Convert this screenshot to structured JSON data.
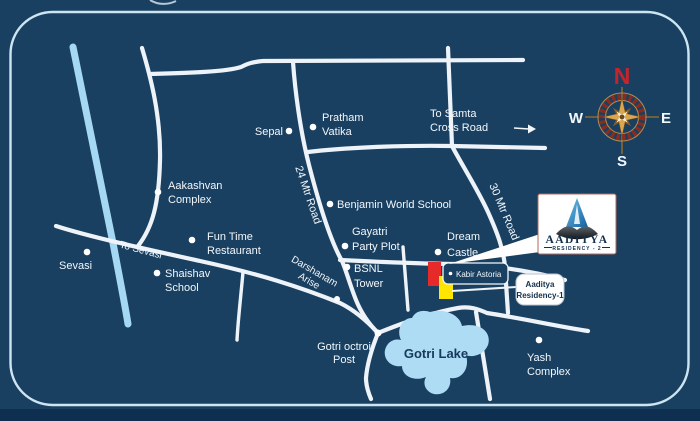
{
  "colors": {
    "background": "#1a4061",
    "page_bottom_strip": "#0f2f51",
    "road": "#edf3f8",
    "frame_border": "#cde5f2",
    "canal": "#a5d8f2",
    "lake": "#aedcf5",
    "lake_text": "#16395c",
    "marker_red": "#e62a2a",
    "marker_yellow": "#ffe600",
    "compass_north": "#c4242b",
    "brand_navy": "#132f4e"
  },
  "places": {
    "sepal": {
      "lines": [
        "Sepal"
      ]
    },
    "pratham_vatika": {
      "lines": [
        "Pratham",
        "Vatika"
      ]
    },
    "samta": {
      "lines": [
        "To Samta",
        "Cross Road"
      ]
    },
    "aakashvan_complex": {
      "lines": [
        "Aakashvan",
        "Complex"
      ]
    },
    "benjamin_world_school": {
      "lines": [
        "Benjamin World School"
      ]
    },
    "gayatri_party_plot": {
      "lines": [
        "Gayatri",
        "Party Plot"
      ]
    },
    "dream_castle": {
      "lines": [
        "Dream",
        "Castle"
      ]
    },
    "bsnl_tower": {
      "lines": [
        "BSNL",
        "Tower"
      ]
    },
    "fun_time_restaurant": {
      "lines": [
        "Fun Time",
        "Restaurant"
      ]
    },
    "shaishav_school": {
      "lines": [
        "Shaishav",
        "School"
      ]
    },
    "sevasi": {
      "lines": [
        "Sevasi"
      ]
    },
    "gotri_octroi_post": {
      "lines": [
        "Gotri octroi",
        "Post"
      ]
    },
    "yash_complex": {
      "lines": [
        "Yash",
        "Complex"
      ]
    },
    "kabir_astoria": {
      "lines": [
        "Kabir Astoria"
      ]
    },
    "gotri_lake": {
      "lines": [
        "Gotri Lake"
      ]
    }
  },
  "road_labels": {
    "mtr24": "24 Mtr Road",
    "mtr30": "30 Mtr Road",
    "to_sevasi": "To Sevasi",
    "darshanam_arise": {
      "lines": [
        "Darshanam",
        "Arise"
      ]
    }
  },
  "compass": {
    "north": "N",
    "south": "S",
    "east": "E",
    "west": "W"
  },
  "brand_callout": {
    "name": "AADITYA",
    "subtitle": "RESIDENCY - 2"
  },
  "residency1_badge": {
    "lines": [
      "Aaditya",
      "Residency-1"
    ]
  }
}
